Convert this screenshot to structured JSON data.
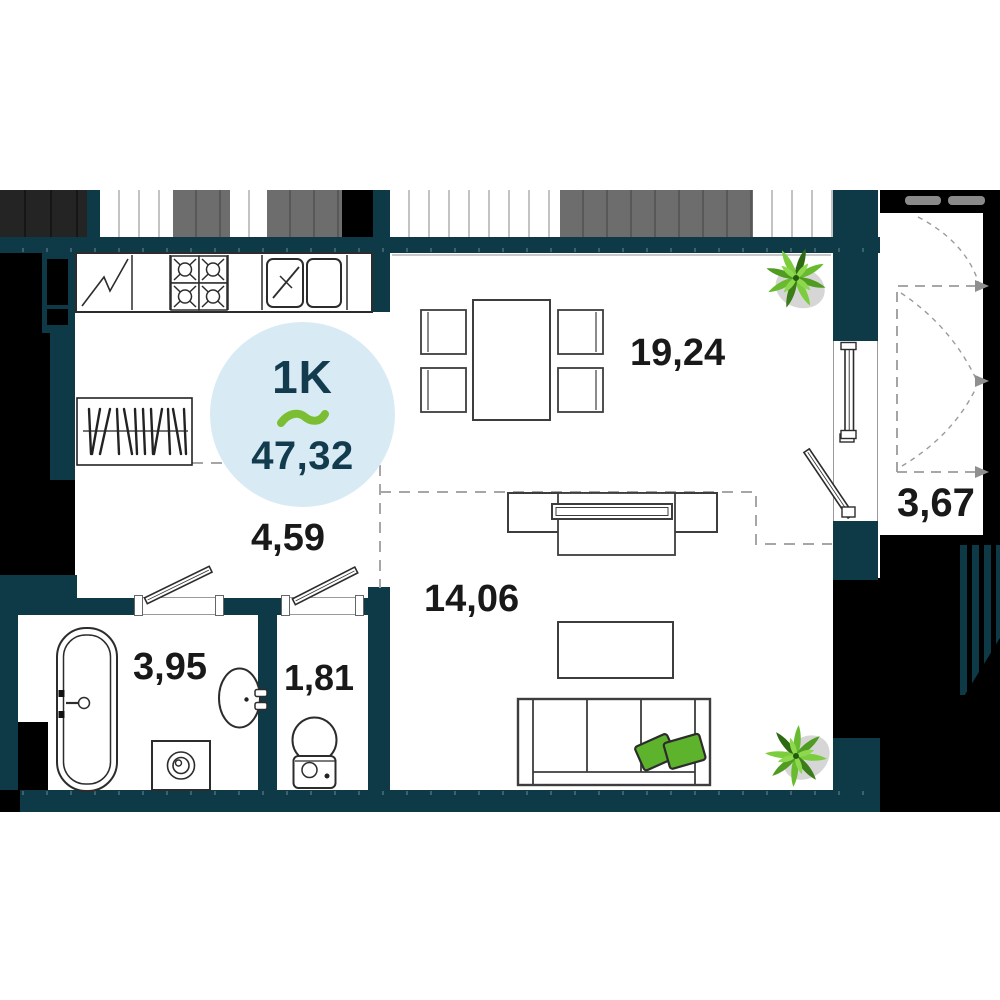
{
  "plan": {
    "badge": {
      "type_label": "1K",
      "separator_icon": "tilde-icon",
      "total_area": "47,32"
    },
    "rooms": [
      {
        "name": "kitchen-living-room",
        "area": "19,24"
      },
      {
        "name": "living-zone",
        "area": "14,06"
      },
      {
        "name": "hallway",
        "area": "4,59"
      },
      {
        "name": "bathroom",
        "area": "3,95"
      },
      {
        "name": "toilet",
        "area": "1,81"
      },
      {
        "name": "balcony",
        "area": "3,67"
      }
    ],
    "colors": {
      "wall": "#0e3947",
      "exterior": "#000000",
      "neighbor_gray": "#6d6d6d",
      "accent_green": "#7cbe33",
      "badge_background": "#d8eaf4",
      "badge_text": "#123c4e",
      "label_text": "#191919",
      "dashed_line": "#a6a6a6"
    },
    "icons": [
      "tilde-icon",
      "plant-icon",
      "fridge-icon",
      "stove-icon",
      "sink-icon",
      "bathtub-icon",
      "washing-machine-icon",
      "toilet-icon",
      "wardrobe-icon",
      "door-leaf-icon",
      "window-icon"
    ]
  }
}
